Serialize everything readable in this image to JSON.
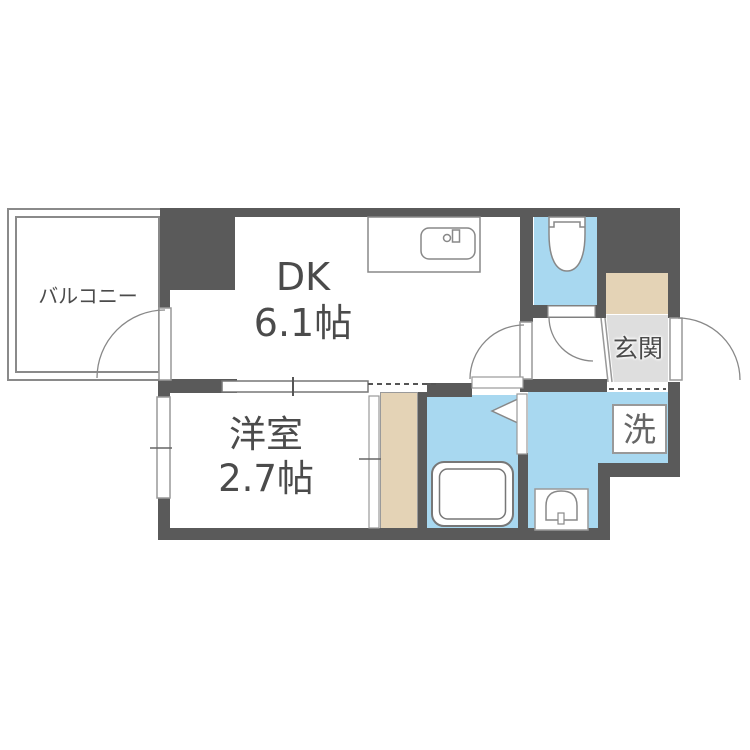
{
  "plan": {
    "balcony": {
      "label": "バルコニー"
    },
    "dk": {
      "label": "DK",
      "size": "6.1帖"
    },
    "western_room": {
      "label": "洋室",
      "size": "2.7帖"
    },
    "entrance": {
      "label": "玄関"
    },
    "laundry": {
      "label": "洗"
    }
  },
  "colors": {
    "wall": "#5a5a5a",
    "blue": "#a8d8f0",
    "beige": "#e4d3b6",
    "gray": "#dedede",
    "text": "#4b4b4b",
    "line": "#8a8a8a"
  }
}
